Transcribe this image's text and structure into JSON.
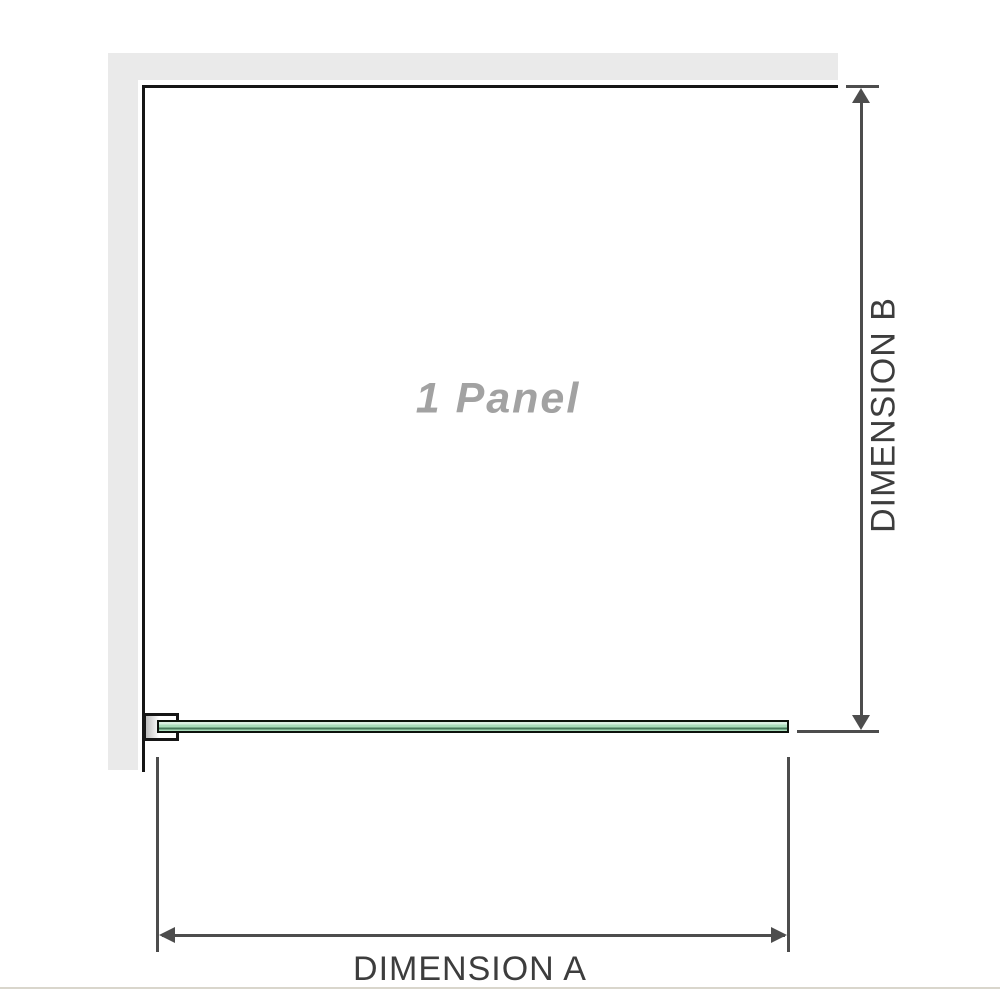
{
  "diagram": {
    "title": "1 Panel",
    "dimensions": {
      "a_label": "DIMENSION A",
      "b_label": "DIMENSION B"
    },
    "colors": {
      "wall": "#eaeaea",
      "outline": "#161616",
      "dimension-line": "#4d4d4d",
      "label-text": "#3d3d3d",
      "panel-title": "#a2a2a2",
      "glass-fill": "#a9dcbb",
      "glass-highlight": "#d9efe2",
      "glass-shadow": "#45785a",
      "glass-border": "#0c120c",
      "baseline": "#d9d6cc"
    }
  }
}
